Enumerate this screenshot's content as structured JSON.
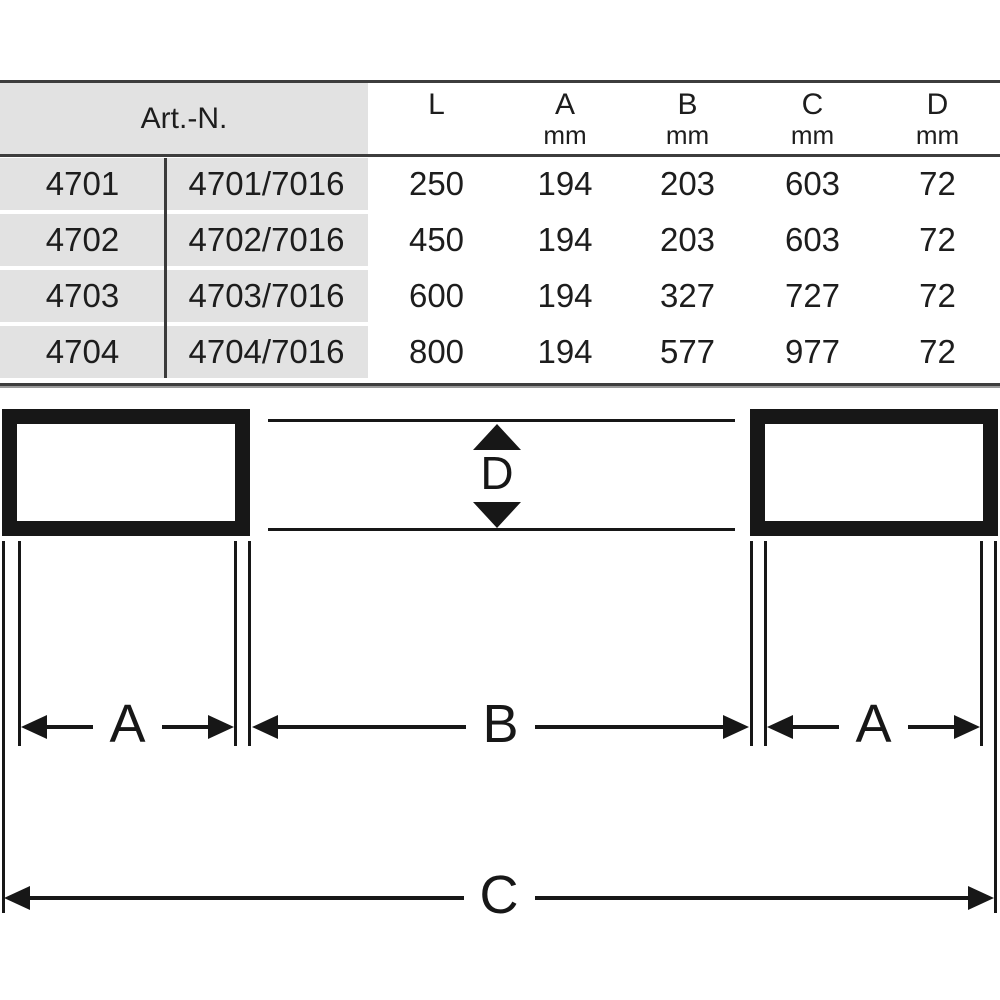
{
  "table": {
    "art_header": "Art.-N.",
    "columns": [
      {
        "letter": "L",
        "unit": ""
      },
      {
        "letter": "A",
        "unit": "mm"
      },
      {
        "letter": "B",
        "unit": "mm"
      },
      {
        "letter": "C",
        "unit": "mm"
      },
      {
        "letter": "D",
        "unit": "mm"
      }
    ],
    "rows": [
      {
        "art": "4701",
        "art2": "4701/7016",
        "l": "250",
        "a": "194",
        "b": "203",
        "c": "603",
        "d": "72"
      },
      {
        "art": "4702",
        "art2": "4702/7016",
        "l": "450",
        "a": "194",
        "b": "203",
        "c": "603",
        "d": "72"
      },
      {
        "art": "4703",
        "art2": "4703/7016",
        "l": "600",
        "a": "194",
        "b": "327",
        "c": "727",
        "d": "72"
      },
      {
        "art": "4704",
        "art2": "4704/7016",
        "l": "800",
        "a": "194",
        "b": "577",
        "c": "977",
        "d": "72"
      }
    ]
  },
  "diagram": {
    "dim_a_left": "A",
    "dim_b": "B",
    "dim_a_right": "A",
    "dim_c": "C",
    "dim_d": "D"
  },
  "colors": {
    "line": "#171717",
    "table_border": "#3d3d3d",
    "header_bg": "#e2e2e2",
    "text": "#1d1d1d"
  }
}
